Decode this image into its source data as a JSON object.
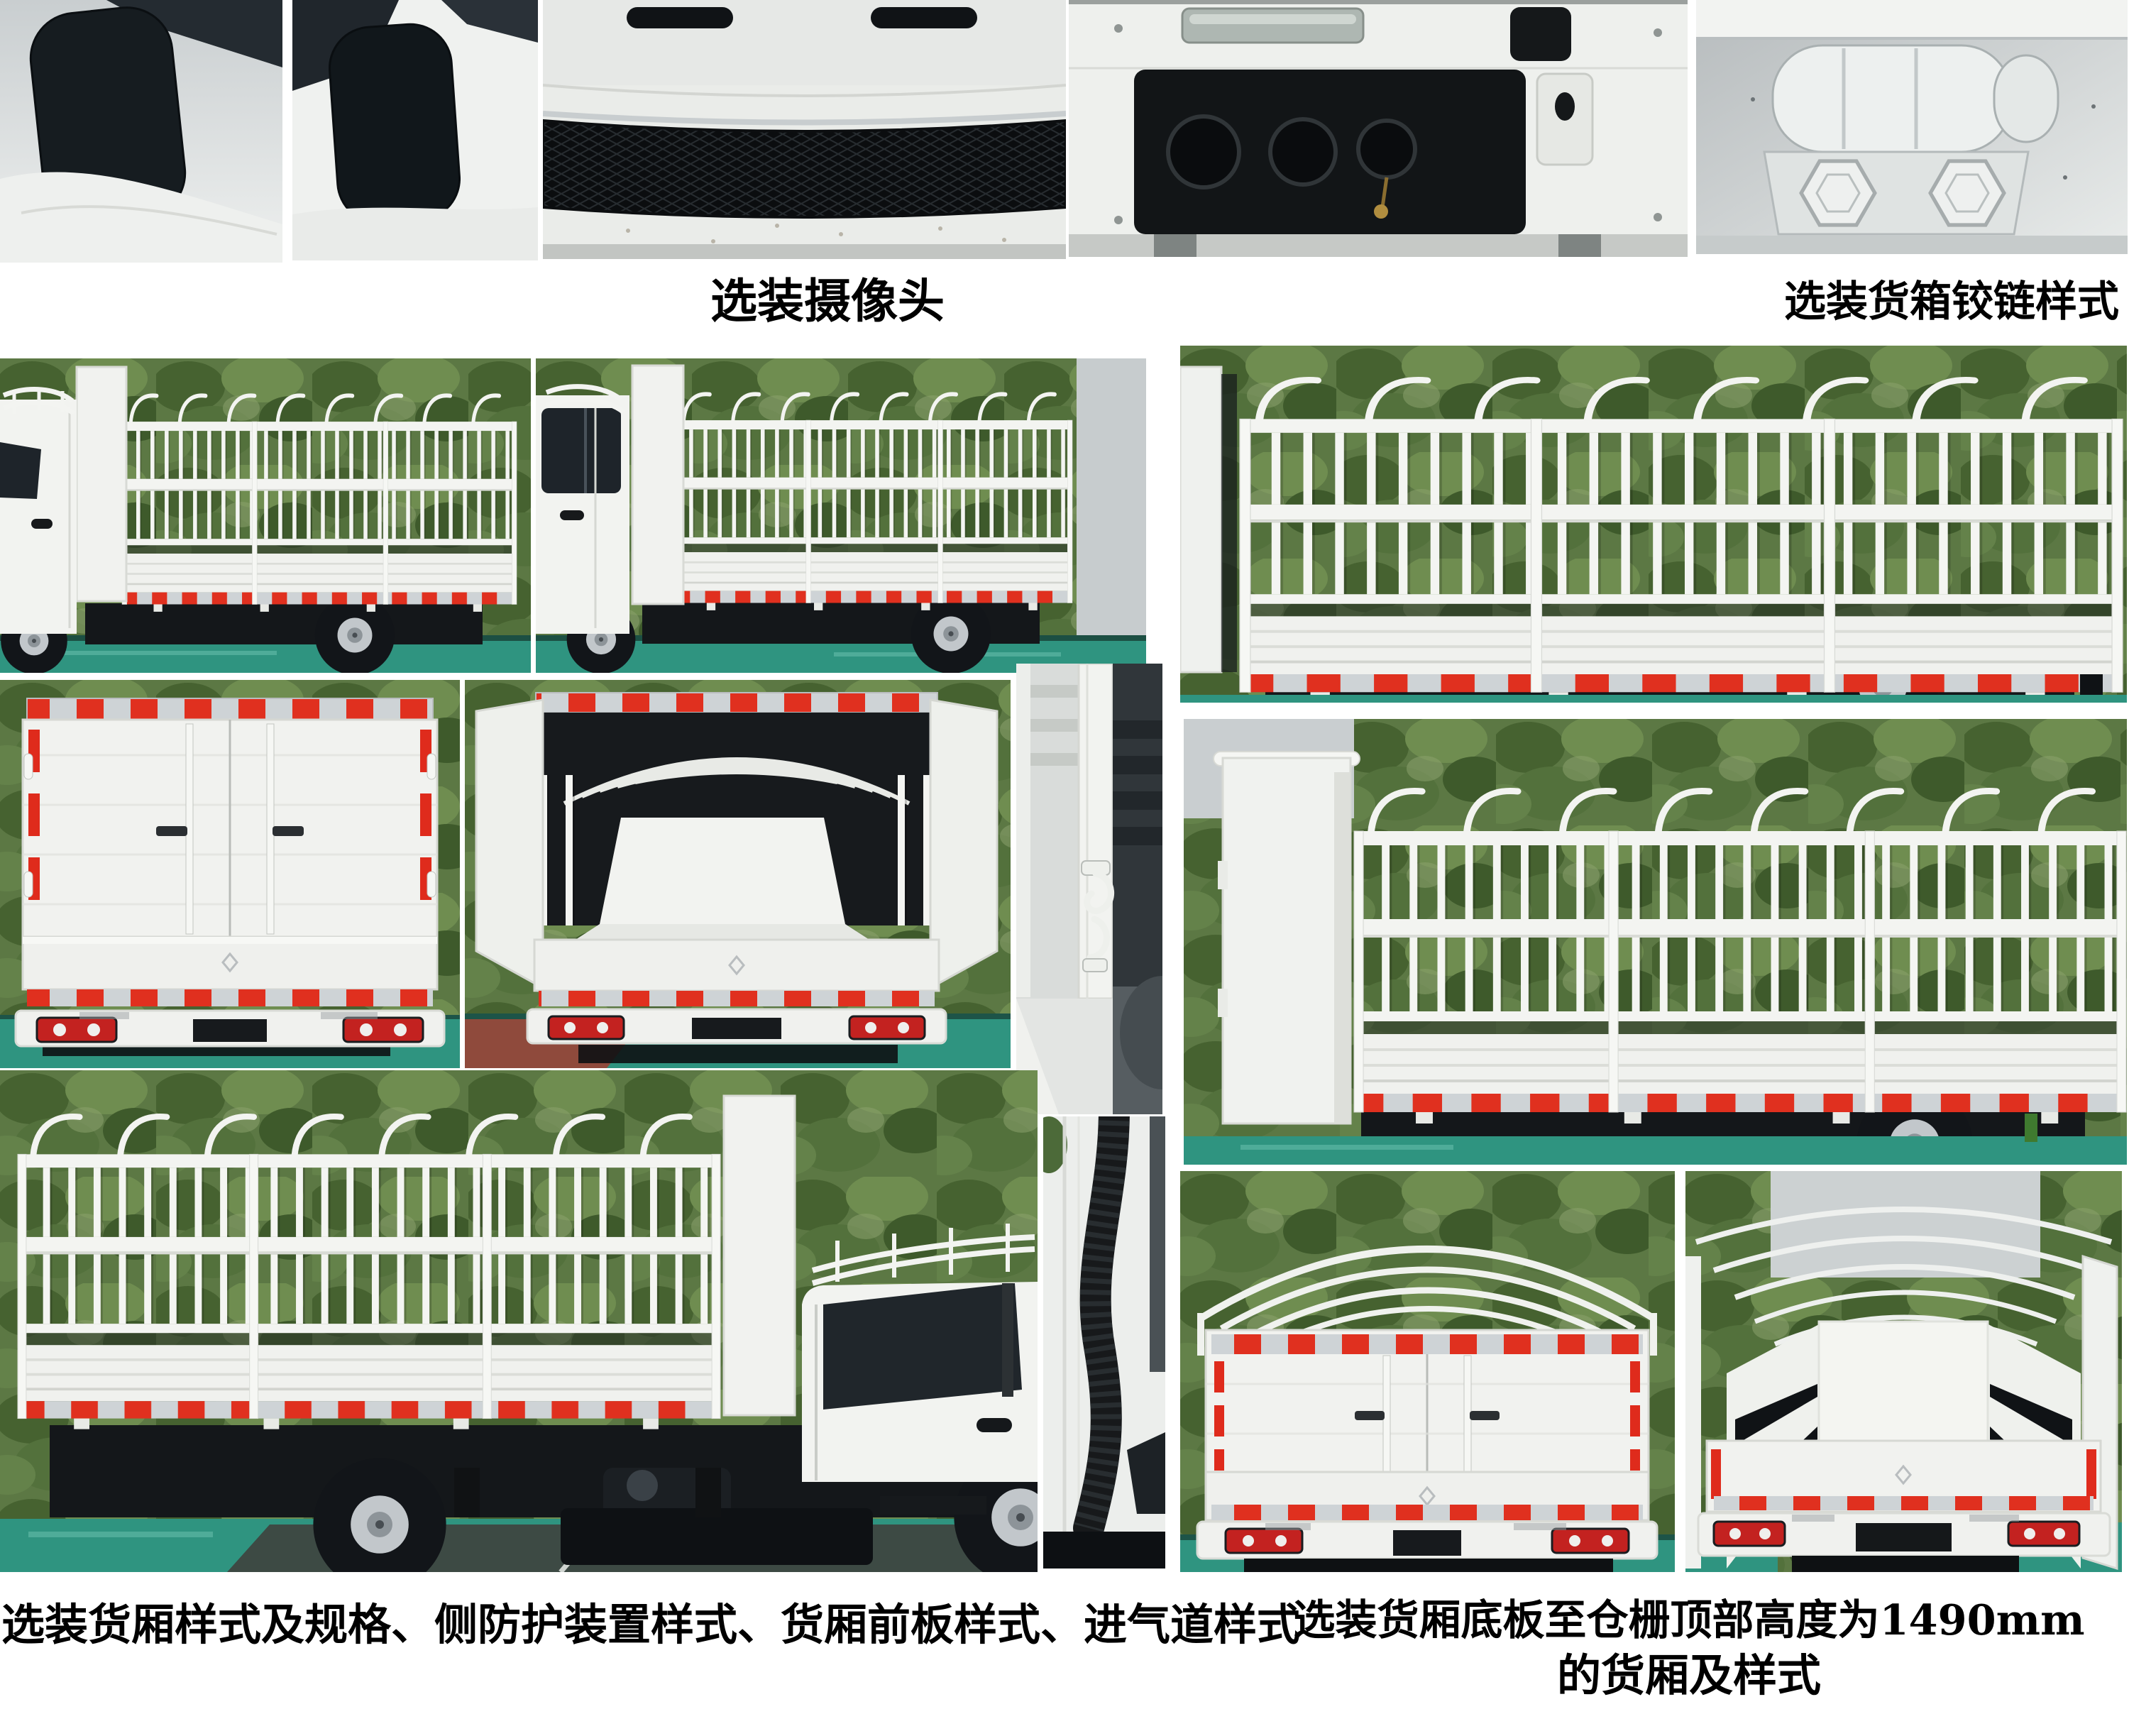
{
  "captions": {
    "camera": "选装摄像头",
    "cargo_hinge": "选装货箱铰链样式",
    "bottom_left": "选装货厢样式及规格、侧防护装置样式、货厢前板样式、进气道样式",
    "bottom_right_line1": "选装货厢底板至仓栅顶部高度为1490mm",
    "bottom_right_line2": "的货厢及样式"
  },
  "colors": {
    "background": "#ffffff",
    "caption_text": "#000000",
    "foliage_green": "#5c7844",
    "ground_teal": "#2f9480",
    "truck_white": "#f2f3f0",
    "reflector_red": "#e0301f",
    "taillight_red": "#c32220",
    "shadow_dark": "#14171a",
    "sky_gray": "#c9ced0"
  }
}
